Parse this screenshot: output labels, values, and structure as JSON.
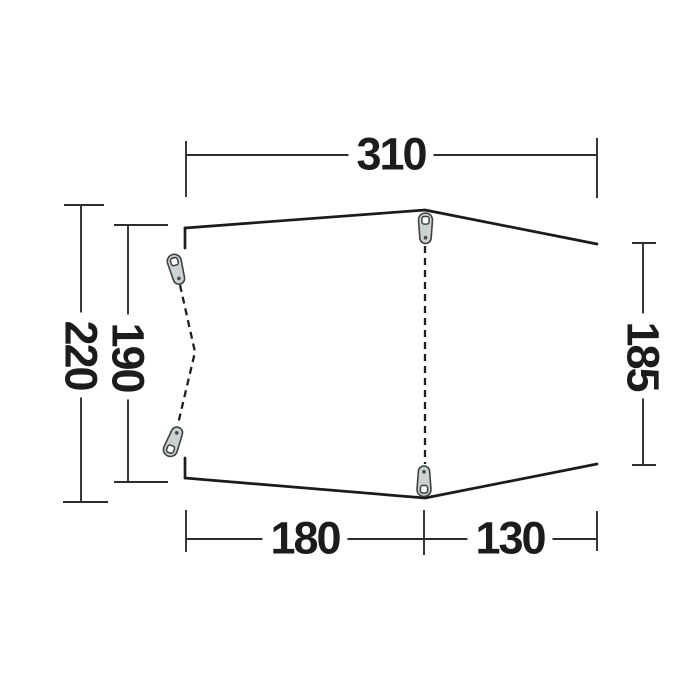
{
  "diagram": {
    "kind": "tent-footprint-dimension-drawing",
    "dimensions": {
      "top_width": "310",
      "left_outer_depth": "220",
      "left_inner_depth": "190",
      "right_height": "185",
      "bottom_left_width": "180",
      "bottom_right_width": "130"
    },
    "colors": {
      "background": "#ffffff",
      "outline": "#1b1b1b",
      "dimension_lines": "#2e2e2e",
      "text": "#1c1c1c",
      "peg_fill": "#ccd1d2",
      "peg_outline": "#3c4042"
    },
    "icons": [
      "guy-point-peg-icon-top-center",
      "guy-point-peg-icon-bottom-center",
      "guy-point-peg-icon-top-left",
      "guy-point-peg-icon-bottom-left"
    ]
  }
}
